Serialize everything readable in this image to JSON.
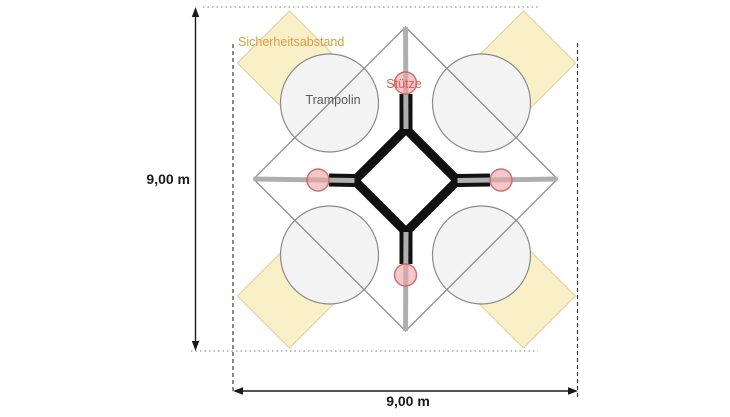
{
  "diagram": {
    "title_hint": "trampoline-installation-plan",
    "labels": {
      "safety": "Sicherheitsabstand",
      "trampoline": "Trampolin",
      "support": "Stütze"
    },
    "dimensions": {
      "left": "9,00 m",
      "bottom": "9,00 m"
    },
    "colors": {
      "background": "#ffffff",
      "safety_fill": "#FAF0C8",
      "safety_stroke": "#E3D4A0",
      "safety_label": "#DB9B3F",
      "trampoline_fill": "#F3F3F3",
      "trampoline_stroke": "#8A8A8A",
      "trampoline_label": "#5A5A5A",
      "support_fill": "rgba(236,163,163,0.6)",
      "support_stroke": "rgba(198,100,100,0.9)",
      "support_label": "#E05A55",
      "frame_black": "#111111",
      "beam_gray": "#AFAFAF",
      "outline_gray": "#8C8C8C",
      "dimension_color": "#1A1A1A",
      "dotted_boundary": "#999999",
      "dashed_boundary": "#3A3A3A"
    }
  }
}
